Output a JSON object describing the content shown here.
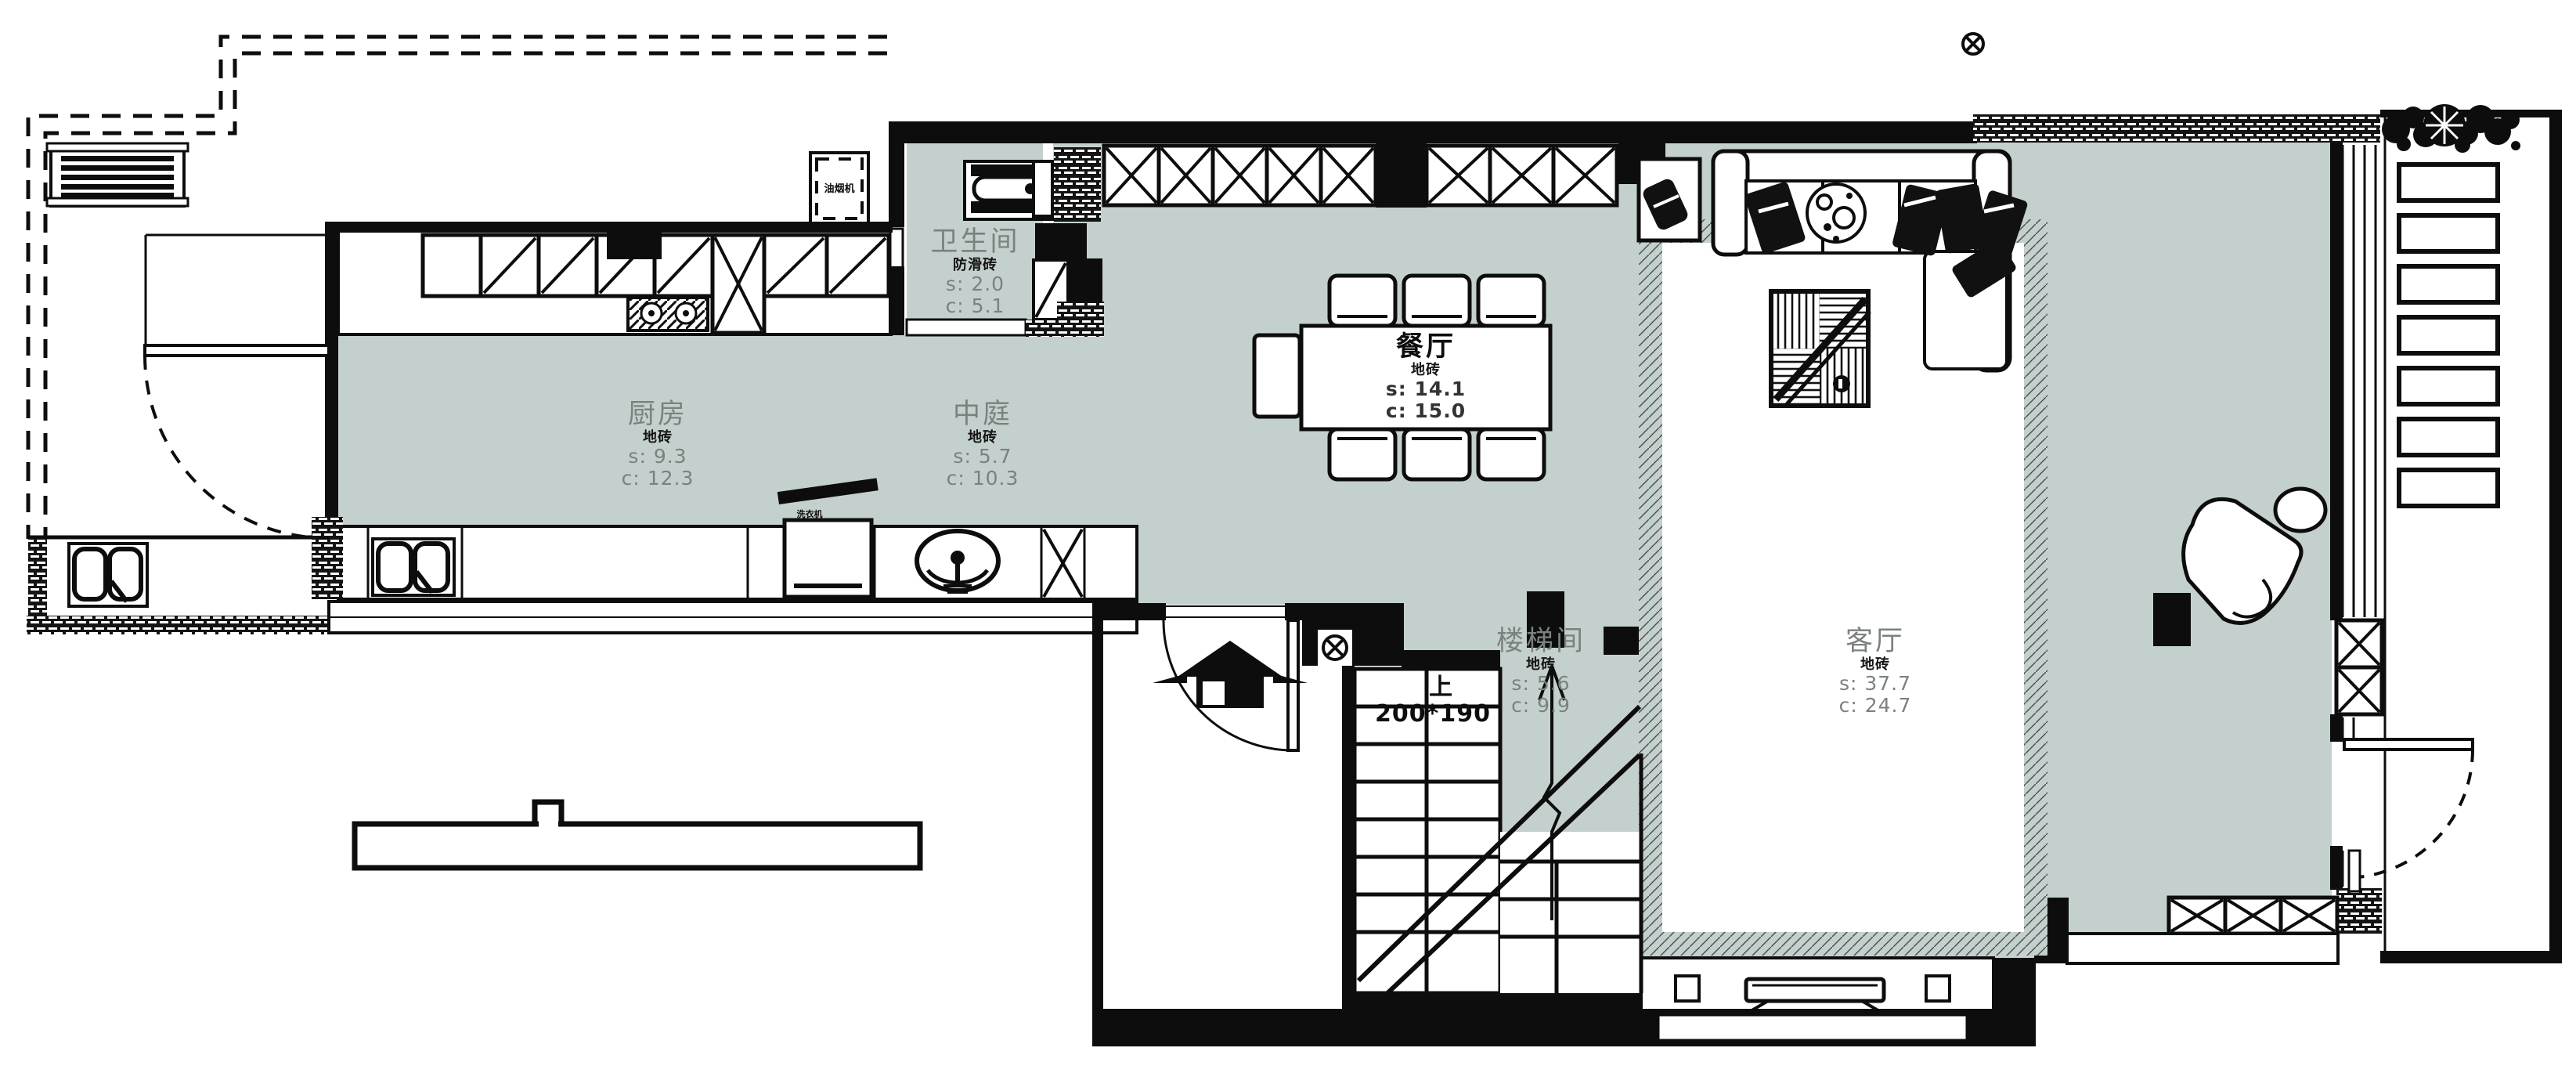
{
  "colors": {
    "floor": "#c4d0cd",
    "wall": "#0d0d0d",
    "label_gray": "#7a827f"
  },
  "rooms": [
    {
      "id": "bathroom",
      "name": "卫生间",
      "finish": "防滑砖",
      "s": "s: 2.0",
      "c": "c: 5.1"
    },
    {
      "id": "kitchen",
      "name": "厨房",
      "finish": "地砖",
      "s": "s: 9.3",
      "c": "c: 12.3"
    },
    {
      "id": "atrium",
      "name": "中庭",
      "finish": "地砖",
      "s": "s: 5.7",
      "c": "c: 10.3"
    },
    {
      "id": "dining",
      "name": "餐厅",
      "finish": "地砖",
      "s": "s: 14.1",
      "c": "c: 15.0"
    },
    {
      "id": "stairwell",
      "name": "楼梯间",
      "finish": "地砖",
      "s": "s: 5.6",
      "c": "c: 9.9"
    },
    {
      "id": "living",
      "name": "客厅",
      "finish": "地砖",
      "s": "s: 37.7",
      "c": "c: 24.7"
    }
  ],
  "stairs": {
    "up": "上",
    "size": "200*190"
  },
  "appliances": {
    "hood": "油烟机",
    "washer": "洗衣机"
  }
}
